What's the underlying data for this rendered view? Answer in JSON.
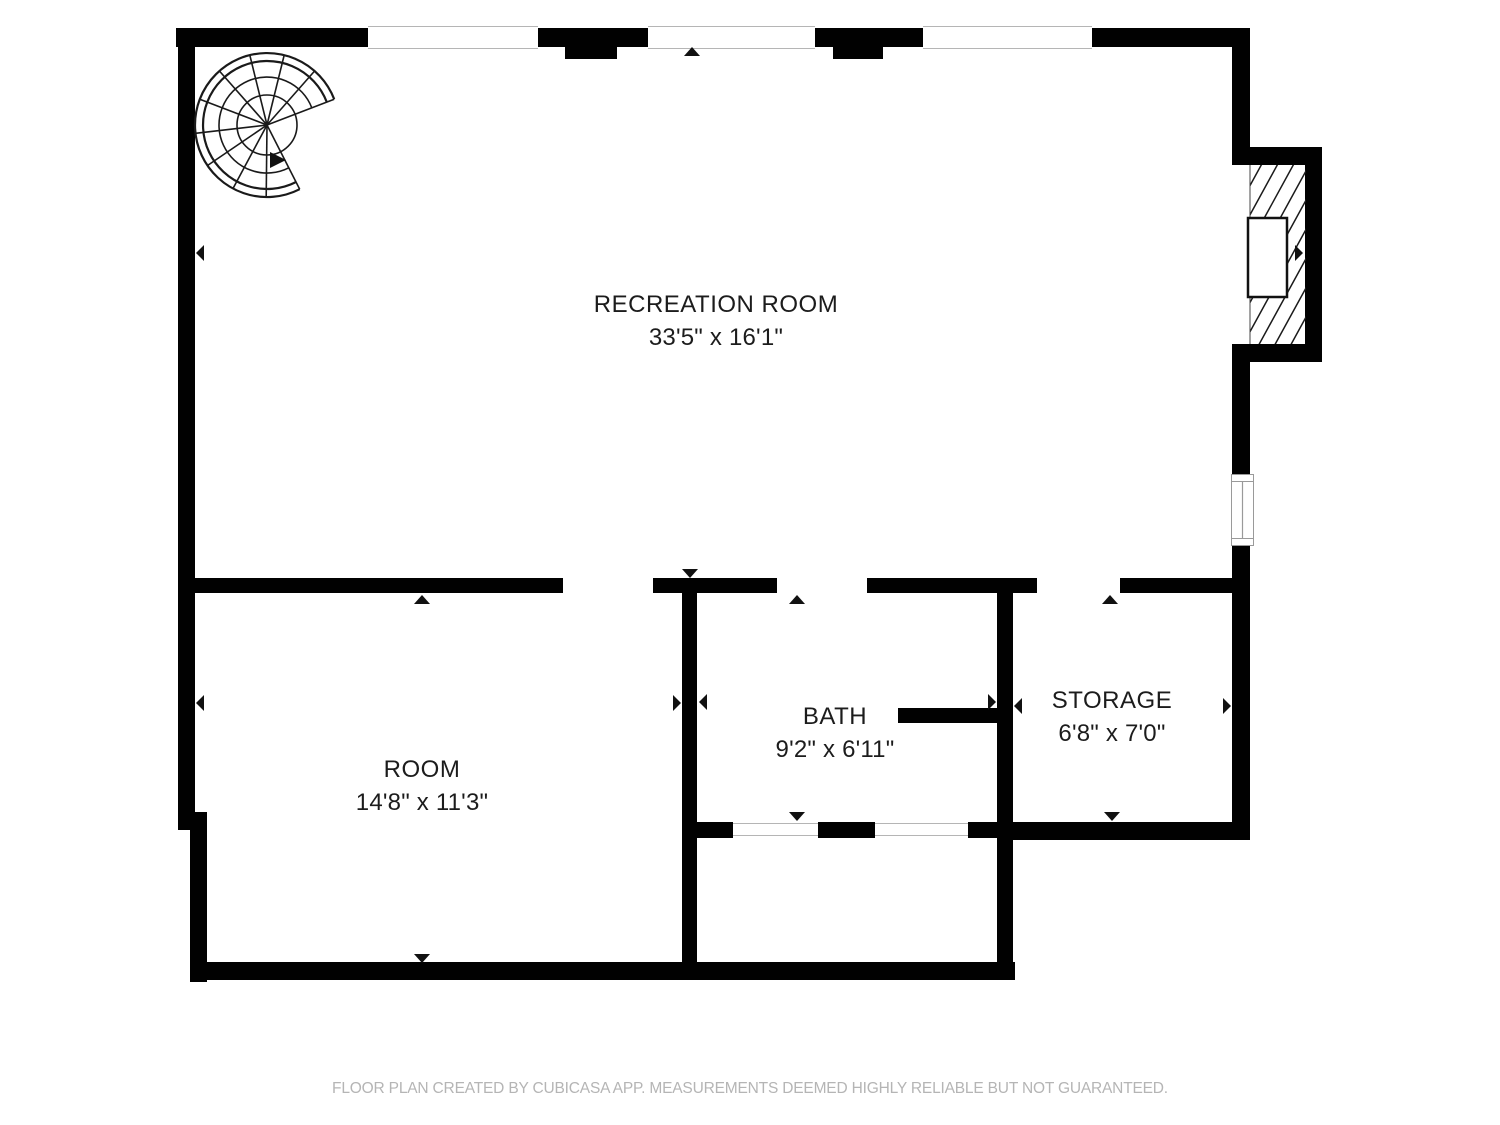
{
  "meta": {
    "app": "CubiCasa floor plan",
    "colors": {
      "bg": "#ffffff",
      "wall": "#010101",
      "label": "#1c1c1c",
      "footer": "#b5b5b5",
      "winline": "#b5b5b5",
      "stair": "#1a1a1a",
      "marker": "#111111"
    },
    "icons": {
      "staircase": "spiral-staircase-icon",
      "fireplace": "hatched-fireplace-icon",
      "opening_marker": "triangle-arrow-icon",
      "window": "window-symbol"
    }
  },
  "rooms": [
    {
      "id": "recreation-room",
      "name": "RECREATION ROOM",
      "dimensions": "33'5\" x 16'1\""
    },
    {
      "id": "room",
      "name": "ROOM",
      "dimensions": "14'8\" x 11'3\""
    },
    {
      "id": "bath",
      "name": "BATH",
      "dimensions": "9'2\" x 6'11\""
    },
    {
      "id": "storage",
      "name": "STORAGE",
      "dimensions": "6'8\" x 7'0\""
    }
  ],
  "footer": {
    "text": "FLOOR PLAN CREATED BY CUBICASA APP. MEASUREMENTS DEEMED HIGHLY RELIABLE BUT NOT GUARANTEED."
  }
}
